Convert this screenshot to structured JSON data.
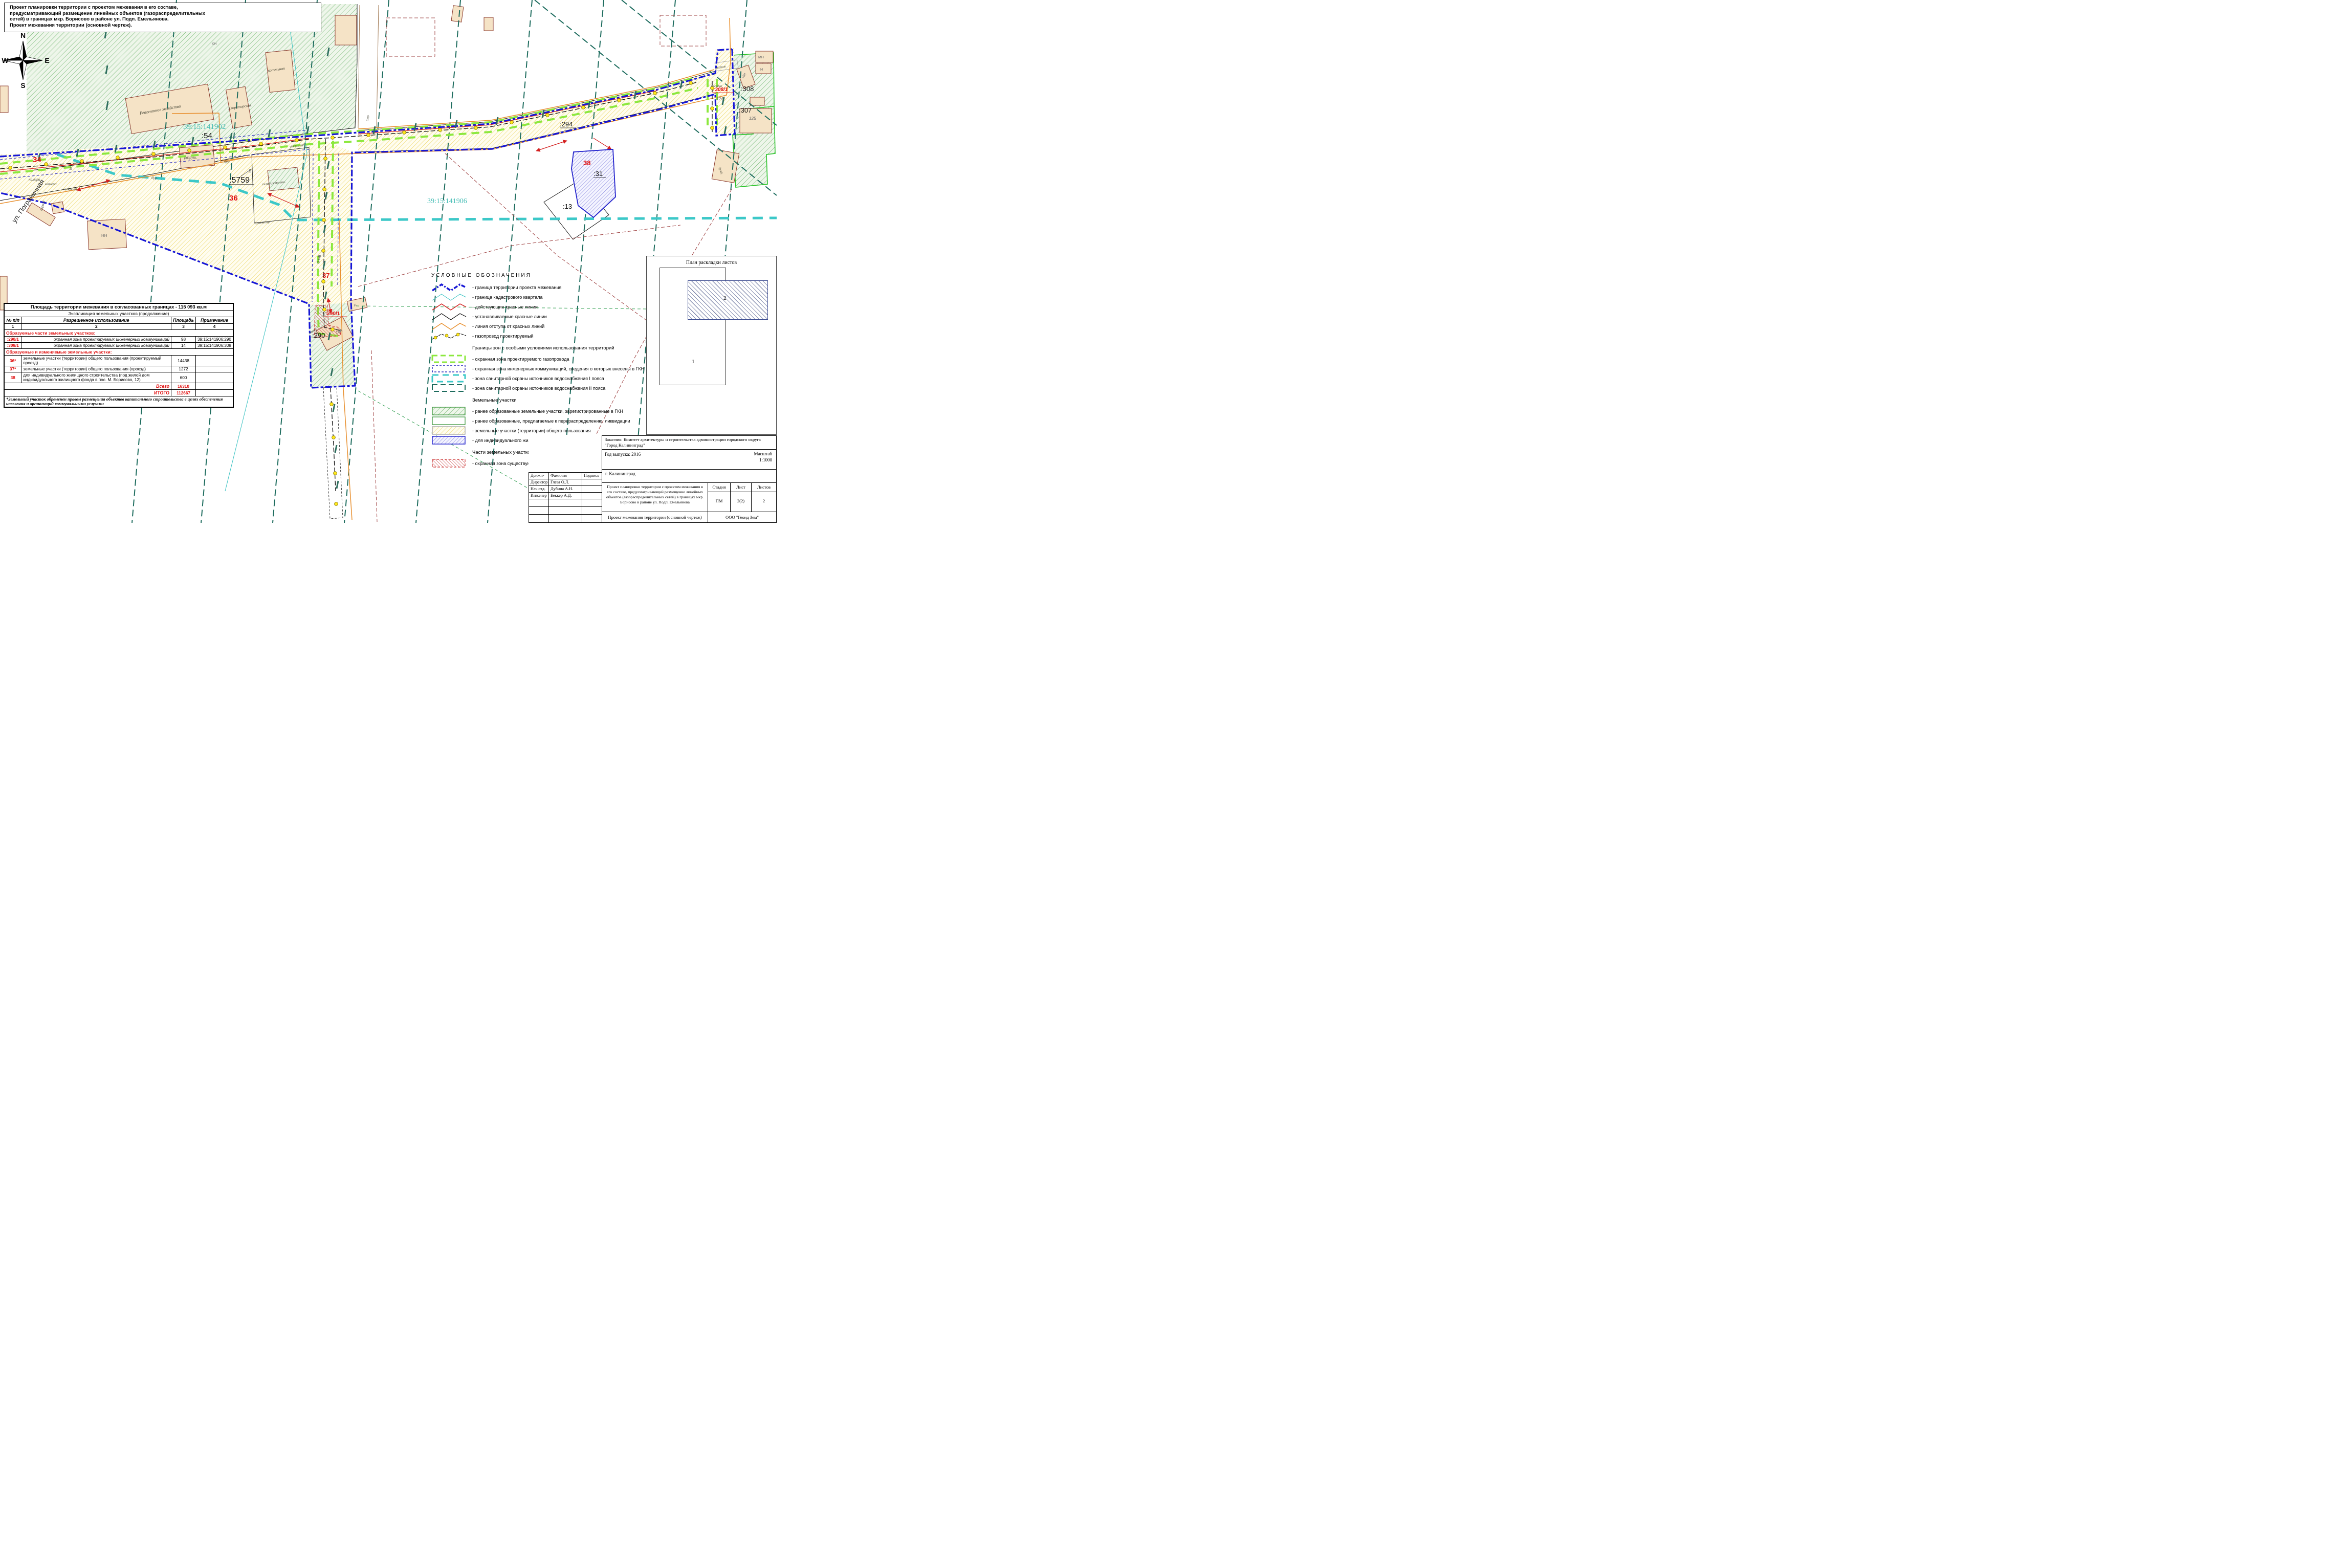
{
  "title_note": {
    "line1": "Проект планировки территории с проектом межевания в его составе,",
    "line2": "предусматривающий размещение линейных объектов (газораспределительных",
    "line3": "сетей) в границах мкр. Борисово в районе ул. Подп. Емельянова.",
    "line4": "Проект межевания территории (основной чертеж)."
  },
  "map": {
    "compass": {
      "n": "N",
      "e": "E",
      "s": "S",
      "w": "W"
    },
    "labels": {
      "quarter_1902": "39:15:141902",
      "quarter_1906": "39:15:141906",
      "p54": ":54",
      "p5759": ":5759",
      "p294": ":294",
      "p31": ":31",
      "p13": ":13",
      "p290": ":290",
      "p307": ":307",
      "p308": ":308",
      "n34": "34",
      "n36": "36",
      "n37": "37",
      "n38": "38",
      "p290_1": ":290/1",
      "p308_1": ":308/1",
      "street": "ул. Пограничная",
      "reagent": "Реагентное хозяйство",
      "chlorator": "Хлораторская",
      "kotelnaya": "котельная",
      "razrush": "разруш.",
      "sklad": "склад ремонтн.",
      "ubezhishche": "убежище",
      "garazh": "гараж",
      "naves": "навес",
      "kamera1": "камера",
      "kamera2": "камера",
      "zakryt": "закрыт",
      "bur1": "бур.",
      "bur2": "бур.",
      "orientir": "ориентир",
      "parnik": "парник",
      "besedka": "беседка",
      "fund": "фунд.",
      "kv04": "0.4кВ",
      "bpr": "б.пр.",
      "l12a": "12А",
      "l12b": "12Б",
      "l14a": "14А",
      "mn": "МН",
      "n1": "Н",
      "n2": "Н",
      "nn1": "НН",
      "nn2": "НН",
      "kn": "КН",
      "v1": "В",
      "v2": "В"
    },
    "colors": {
      "project_boundary": "#1616d6",
      "cadastral_quarter": "#39c2c2",
      "existing_red_lines": "#d42020",
      "new_red_lines": "#111111",
      "offset_line": "#e89030",
      "gas_zone": "#8ce83e",
      "wss_zone_1": "#3cc8c8",
      "wss_zone_2": "#1c6b5d",
      "red_parcel_number": "#e01010",
      "cadastral_label": "#45bdb5"
    }
  },
  "table": {
    "title": "Площадь территории межевания в согласованных границах - 115 093 кв.м",
    "subtitle": "Экспликация земельных участков (продолжение)",
    "col_headers": [
      "№ п/п",
      "Разрешенное использование",
      "Площадь",
      "Примечание"
    ],
    "col_numbers": [
      "1",
      "2",
      "3",
      "4"
    ],
    "section1": "Образуемые части земельных участков:",
    "rows1": [
      {
        "num": ":290/1",
        "use": "охранная зона проектируемых инженерных коммуникаций",
        "area": "98",
        "note": "39:15:141906:290"
      },
      {
        "num": ":308/1",
        "use": "охранная зона проектируемых инженерных коммуникаций",
        "area": "14",
        "note": "39:15:141906:308"
      }
    ],
    "section2": "Образуемые и изменяемые земельные участки:",
    "rows2": [
      {
        "num": "36*",
        "use": "земельные участки (территории) общего пользования (проектируемый проезд)",
        "area": "14438",
        "note": ""
      },
      {
        "num": "37*",
        "use": "земельные участки (территории) общего пользования (проезд)",
        "area": "1272",
        "note": ""
      },
      {
        "num": "38",
        "use": "для индивидуального жилищного строительства (под жилой дом индивидуального жилищного фонда в пос. М. Борисово, 12)",
        "area": "600",
        "note": ""
      }
    ],
    "total_label": "Всего",
    "total_value": "16310",
    "grand_total_label": "ИТОГО",
    "grand_total_value": "112667",
    "footnote": "*Земельный участок обременен правом размещения объектов капитального строительства в целях обеспечения населения и организаций коммунальными услугами"
  },
  "legend": {
    "header": "УСЛОВНЫЕ   ОБОЗНАЧЕНИЯ",
    "items": [
      {
        "key": "project-boundary",
        "label": "- граница территории проекта межевания"
      },
      {
        "key": "cadastral-quarter",
        "label": "- граница кадастрового квартала"
      },
      {
        "key": "existing-red-lines",
        "label": "- действующие красные линии"
      },
      {
        "key": "new-red-lines",
        "label": "- устанавливаемые красные линии"
      },
      {
        "key": "red-line-offset",
        "label": "- линия отступа от красных линий"
      },
      {
        "key": "gas-pipeline-planned",
        "label": "- газопровод проектируемый"
      }
    ],
    "zones_header": "Границы зон с особыми условиями использования территорий",
    "zone_items": [
      {
        "key": "gas-protection-zone",
        "label": "- охранная зона проектируемого газопровода"
      },
      {
        "key": "gkn-utilities-zone",
        "label": "- охранная зона инженерных коммуникаций, сведения о которых внесены в ГКН"
      },
      {
        "key": "water-zone-1",
        "label": "- зона санитарной охраны источников водоснабжения I пояса"
      },
      {
        "key": "water-zone-2",
        "label": "- зона санитарной охраны источников водоснабжения II пояса"
      }
    ],
    "parcels_header": "Земельные участки",
    "parcel_items": [
      {
        "key": "registered-gkn",
        "label": "- ранее образованные земельные участки, зарегистрированные в ГКН"
      },
      {
        "key": "redistribution",
        "label": "- ранее образованные, предлагаемые к перераспределению, ликвидации"
      },
      {
        "key": "common-use",
        "label": "- земельные участки (территории) общего пользования"
      },
      {
        "key": "individual-housing",
        "label": "- для индивидуального жилищного строительства"
      }
    ],
    "parts_header": "Части земельных участков",
    "part_items": [
      {
        "key": "utilities-protection",
        "label": "- охранная зона существующих и проектируемых инженерных коммуникаций"
      }
    ]
  },
  "sheet_plan": {
    "title": "План раскладки листов",
    "sheet1": "1",
    "sheet2": "2"
  },
  "title_block": {
    "customer": "Заказчик: Комитет архитектуры и строительства администрации городского округа \"Город Калининград\"",
    "year": "Год выпуска: 2016",
    "scale_label": "Масштаб",
    "scale_value": "1:1000",
    "city": "г. Калининград",
    "staff_headers": [
      "Должн-ть",
      "Фамилия",
      "Подпись"
    ],
    "staff": [
      {
        "role": "Директор",
        "name": "Глеза О.Л."
      },
      {
        "role": "Нач.отд.",
        "name": "Дубина А.Н."
      },
      {
        "role": "Инженер",
        "name": "Беккер А.Д."
      }
    ],
    "project_description": "Проект планировки территории с проектом межевания в его составе, предусматривающий размещение линейных объектов (газораспределительных сетей) в границах мкр. Борисово в районе ул. Подп. Емельянова",
    "stage_header": "Стадия",
    "sheet_header": "Лист",
    "sheets_header": "Листов",
    "stage": "ПМ",
    "sheet": "2(2)",
    "sheets": "2",
    "doc_title": "Проект межевания территории (основной чертеж)",
    "company": "ООО \"Геоид Зем\""
  }
}
